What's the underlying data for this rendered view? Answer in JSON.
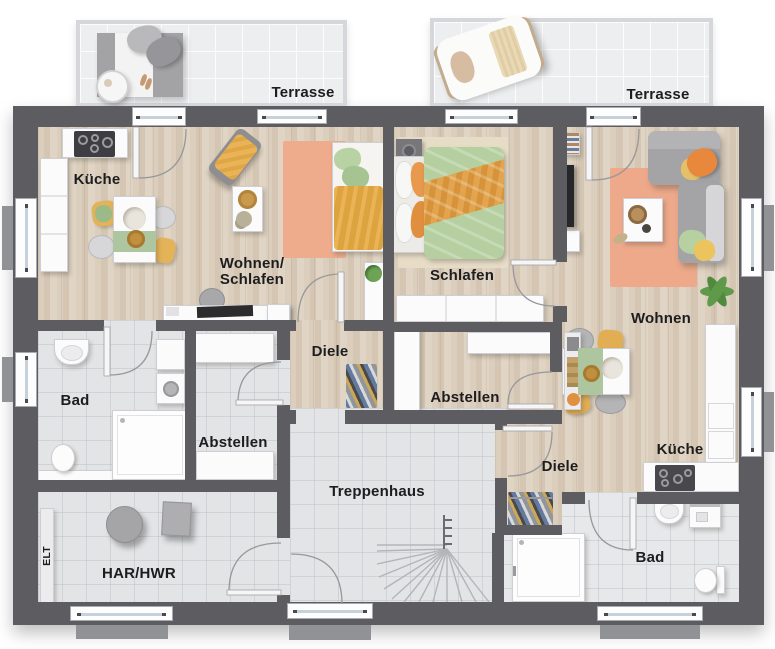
{
  "rooms": {
    "terrasse_left": "Terrasse",
    "terrasse_right": "Terrasse",
    "kueche_left": "Küche",
    "wohnen_schlafen_line1": "Wohnen/",
    "wohnen_schlafen_line2": "Schlafen",
    "schlafen_right": "Schlafen",
    "wohnen_right": "Wohnen",
    "diele_left": "Diele",
    "diele_right": "Diele",
    "abstellen_left": "Abstellen",
    "abstellen_right": "Abstellen",
    "bad_left": "Bad",
    "bad_right": "Bad",
    "kueche_right": "Küche",
    "treppenhaus": "Treppenhaus",
    "har_hwr": "HAR/HWR",
    "elt": "ELT"
  },
  "colors": {
    "wall": "#5d5d61",
    "wood_floor": "#d8cbba",
    "tile_floor": "#e3e4e6",
    "terrace": "#edeef0",
    "rug_salmon": "#efac8c",
    "accent_yellow": "#e8b254",
    "accent_orange": "#e8883c",
    "accent_green": "#b7d0a2",
    "sofa_gray": "#a4a4a7",
    "label_text": "#1d1d1f"
  }
}
